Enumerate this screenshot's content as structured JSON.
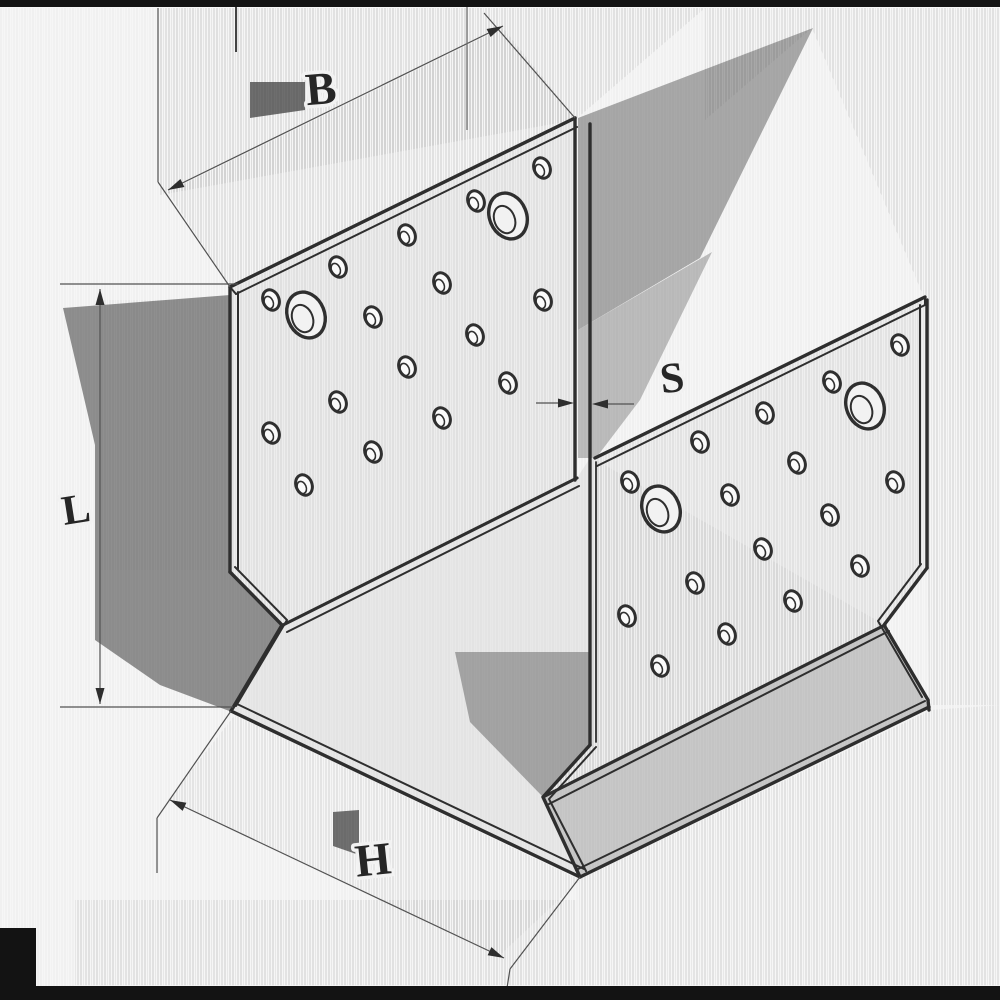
{
  "diagram": {
    "type": "isometric-technical-drawing",
    "subject": "perforated-angle-channel-connector",
    "dimension_labels": {
      "b": "B",
      "s": "S",
      "l": "L",
      "h": "H"
    },
    "colors": {
      "background": "#f6f6f6",
      "outline": "#2e2e2e",
      "dim_line": "#525252",
      "label": "#262626",
      "shadow_dark": "#8f8f8f",
      "shadow_mid": "#a8a8a8",
      "shadow_light": "#c8c8c8",
      "plate_face": "#ededed",
      "edge_bar": "#131313"
    },
    "plates": {
      "left": {
        "small_holes": [
          [
            542,
            168
          ],
          [
            476,
            201
          ],
          [
            407,
            235
          ],
          [
            338,
            267
          ],
          [
            271,
            300
          ],
          [
            442,
            283
          ],
          [
            543,
            300
          ],
          [
            373,
            317
          ],
          [
            475,
            335
          ],
          [
            407,
            367
          ],
          [
            508,
            383
          ],
          [
            338,
            402
          ],
          [
            442,
            418
          ],
          [
            271,
            433
          ],
          [
            373,
            452
          ],
          [
            304,
            485
          ]
        ],
        "big_holes": [
          [
            508,
            216
          ],
          [
            306,
            315
          ]
        ]
      },
      "right": {
        "small_holes": [
          [
            900,
            345
          ],
          [
            832,
            382
          ],
          [
            765,
            413
          ],
          [
            700,
            442
          ],
          [
            797,
            463
          ],
          [
            895,
            482
          ],
          [
            730,
            495
          ],
          [
            830,
            515
          ],
          [
            630,
            482
          ],
          [
            763,
            549
          ],
          [
            860,
            566
          ],
          [
            695,
            583
          ],
          [
            793,
            601
          ],
          [
            627,
            616
          ],
          [
            727,
            634
          ],
          [
            660,
            666
          ]
        ],
        "big_holes": [
          [
            865,
            406
          ],
          [
            661,
            509
          ]
        ]
      }
    },
    "hole_style": {
      "small": {
        "rx": 8,
        "ry": 10.5,
        "rotation": -22
      },
      "big": {
        "rx": 18.5,
        "ry": 23.5,
        "rotation": -22
      }
    }
  }
}
